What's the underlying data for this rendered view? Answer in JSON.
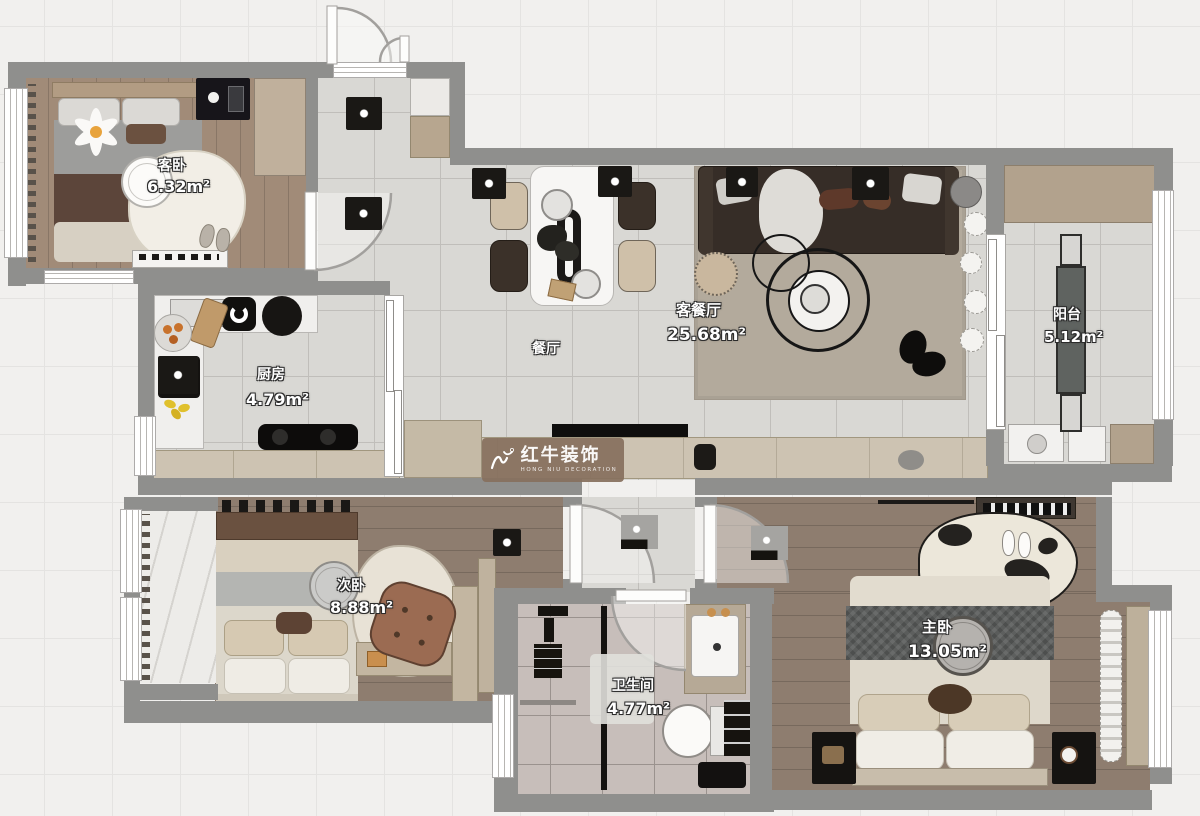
{
  "rooms": {
    "guest_bedroom": {
      "name": "客卧",
      "area": "6.32m²"
    },
    "kitchen": {
      "name": "厨房",
      "area": "4.79m²"
    },
    "dining": {
      "name": "餐厅",
      "area": ""
    },
    "living_dining": {
      "name": "客餐厅",
      "area": "25.68m²"
    },
    "balcony": {
      "name": "阳台",
      "area": "5.12m²"
    },
    "second_bedroom": {
      "name": "次卧",
      "area": "8.88m²"
    },
    "bathroom": {
      "name": "卫生间",
      "area": "4.77m²"
    },
    "master_bedroom": {
      "name": "主卧",
      "area": "13.05m²"
    }
  },
  "watermark": {
    "brand": "红牛装饰",
    "subtitle": "HONG NIU DECORATION"
  },
  "colors": {
    "wall": "#8f8f8d",
    "floor_tile": "#d9d8d4",
    "wood_floor": "#9a8573",
    "bath_tile": "#c7beba",
    "living_rug": "#b3aa9c",
    "sofa": "#362d27",
    "cabinet_tan": "#c9bfae",
    "watermark_brown": "#86705e",
    "label_text": "#ffffff"
  }
}
